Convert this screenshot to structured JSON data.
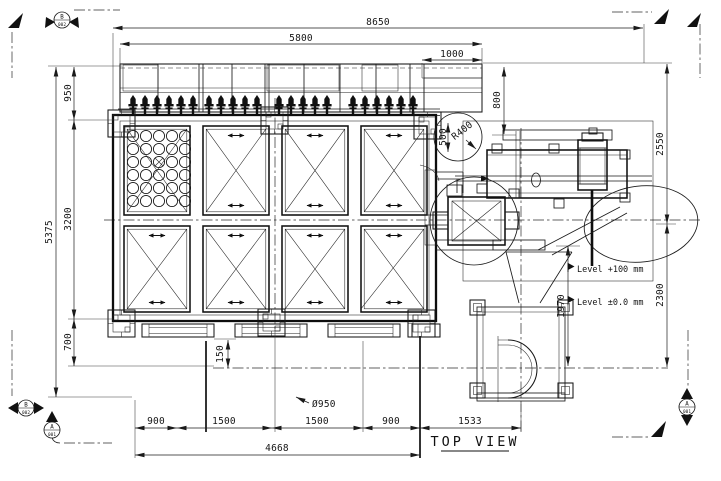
{
  "view": {
    "title": "TOP VIEW"
  },
  "colors": {
    "line": "#1a1a1a",
    "background": "#ffffff"
  },
  "dims": {
    "overall_width": "8650",
    "platform_width": "5800",
    "platform_ext": "1000",
    "height_total": "5375",
    "height_top": "950",
    "height_tank": "3200",
    "height_bottom": "700",
    "walkway_drop": "800",
    "right_upper": "2550",
    "right_lower": "2300",
    "pump_frame": "1970",
    "rail_to_axis": "150",
    "pipe_diameter": "Ø950",
    "bay_a": "900",
    "bay_b": "1500",
    "bay_c": "1500",
    "bay_d": "900",
    "pump_offset": "1533",
    "base_total": "4668",
    "detail_offset": "500",
    "detail_radius": "R400"
  },
  "levels": {
    "high": "Level +100 mm",
    "zero": "Level ±0.0 mm"
  },
  "markers": {
    "b": {
      "letter": "B",
      "sheet": "002"
    },
    "a": {
      "letter": "A",
      "sheet": "001"
    }
  },
  "structure": {
    "tank_cells": 8,
    "nozzles": 22,
    "perforated_cell_grid": "5x6"
  }
}
